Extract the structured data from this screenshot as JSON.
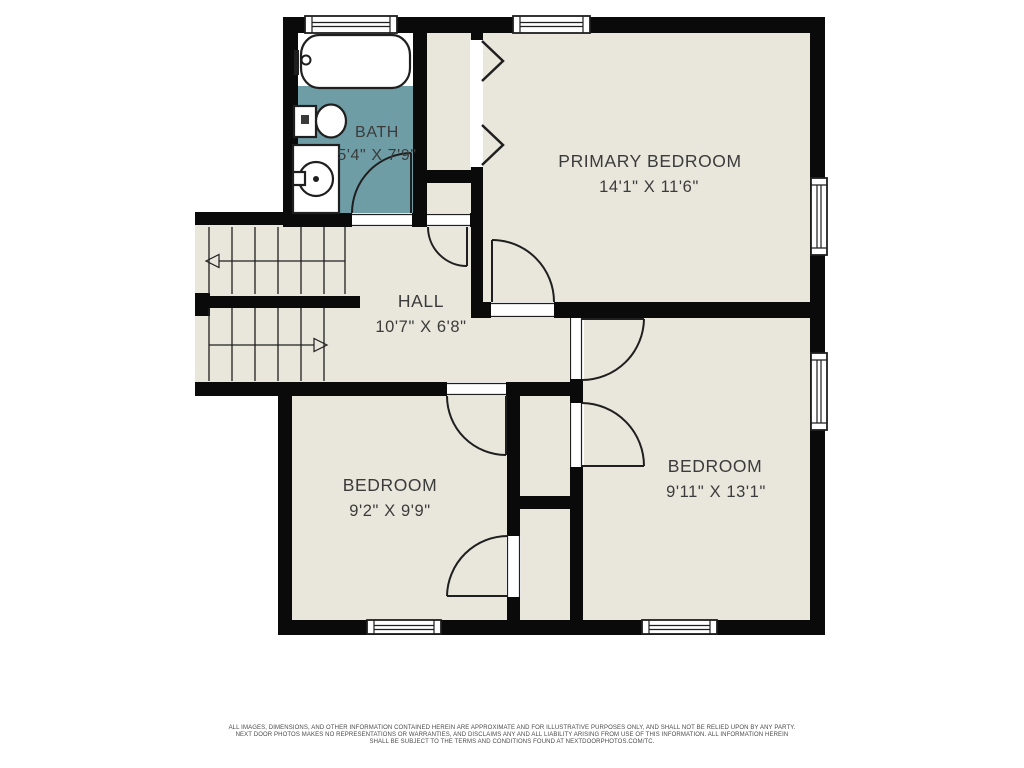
{
  "colors": {
    "bg": "#ffffff",
    "floor": "#e9e7dc",
    "bath": "#6f9da6",
    "wall": "#0a0a0a",
    "line": "#1f1f1f",
    "label": "#3b3b3b",
    "muted": "#4a4a4a"
  },
  "rooms": {
    "bath": {
      "name": "BATH",
      "dims": "5'4\" X 7'9\""
    },
    "primary_bedroom": {
      "name": "PRIMARY BEDROOM",
      "dims": "14'1\" X 11'6\""
    },
    "hall": {
      "name": "HALL",
      "dims": "10'7\" X 6'8\""
    },
    "bedroom_left": {
      "name": "BEDROOM",
      "dims": "9'2\" X 9'9\""
    },
    "bedroom_right": {
      "name": "BEDROOM",
      "dims": "9'11\" X 13'1\""
    }
  },
  "disclaimer": {
    "line1": "ALL IMAGES, DIMENSIONS, AND OTHER INFORMATION CONTAINED HEREIN ARE APPROXIMATE AND FOR ILLUSTRATIVE PURPOSES ONLY, AND SHALL NOT BE RELIED UPON BY ANY PARTY.",
    "line2": "NEXT DOOR PHOTOS MAKES NO REPRESENTATIONS OR WARRANTIES, AND DISCLAIMS ANY AND ALL LIABILITY ARISING FROM USE OF THIS INFORMATION. ALL INFORMATION HEREIN",
    "line3": "SHALL BE SUBJECT TO THE TERMS AND CONDITIONS FOUND AT NEXTDOORPHOTOS.COM/TC."
  }
}
